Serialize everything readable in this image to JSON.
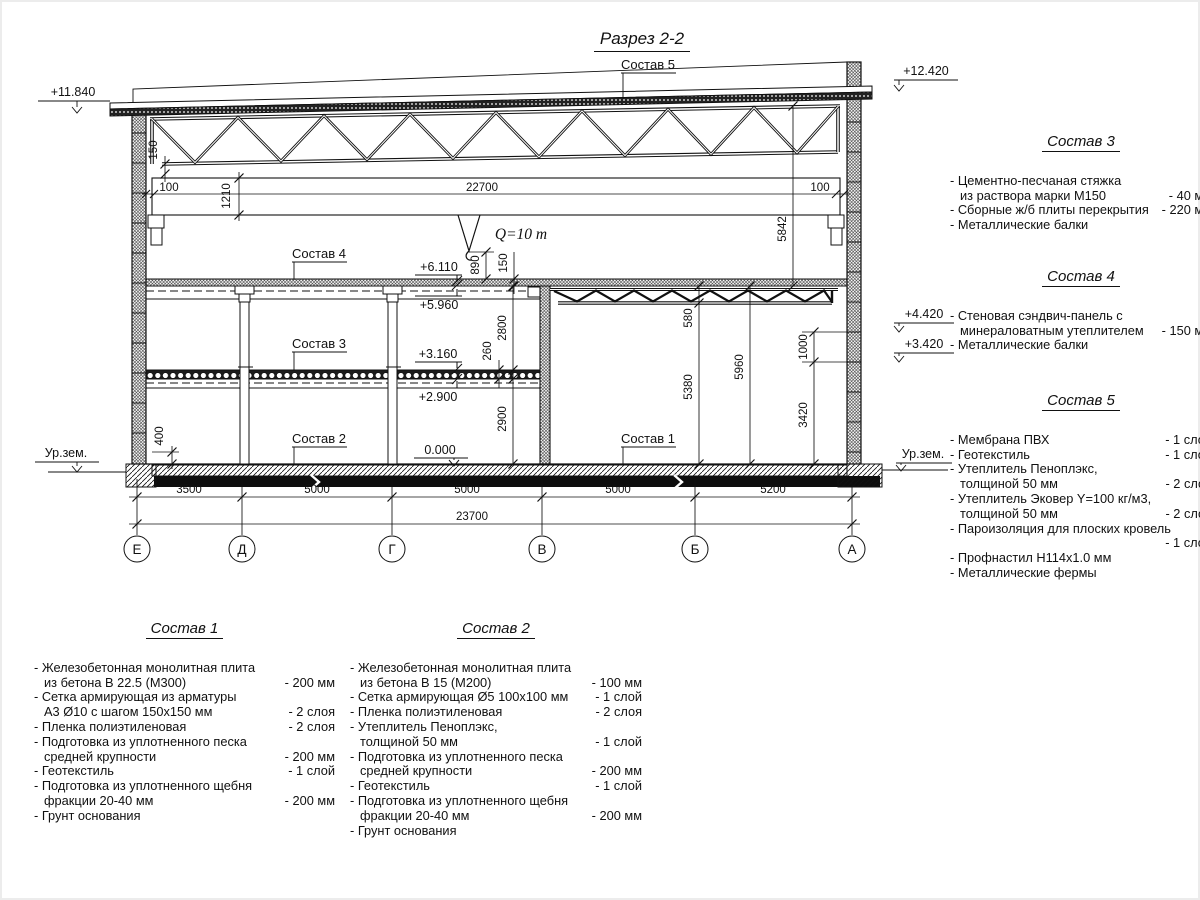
{
  "title": "Разрез 2-2",
  "drawing": {
    "crane_label": "Q=10 т",
    "leaders": {
      "sostav5": "Состав 5",
      "sostav4": "Состав 4",
      "sostav3": "Состав 3",
      "sostav2": "Состав 2",
      "sostav1": "Состав 1"
    },
    "elevations": {
      "roof_left": "+11.840",
      "roof_right": "+12.420",
      "wall_upper": "+4.420",
      "wall_lower": "+3.420",
      "floor2_top": "+6.110",
      "floor2_bottom": "+5.960",
      "floor1_top": "+3.160",
      "floor1_bottom": "+2.900",
      "zero": "0.000",
      "ground_left": "Ур.зем.",
      "ground_right": "Ур.зем."
    },
    "dims_crane": {
      "left_gap": "100",
      "length": "22700",
      "right_gap": "100"
    },
    "dims_bottom": {
      "spans": [
        "3500",
        "5000",
        "5000",
        "5000",
        "5200"
      ],
      "total": "23700"
    },
    "dims_vertical": {
      "v150_left": "150",
      "v1210": "1210",
      "v890": "890",
      "v150_mid": "150",
      "v2800": "2800",
      "v260": "260",
      "v2900": "2900",
      "v400": "400",
      "v5842": "5842",
      "v580": "580",
      "v5380": "5380",
      "v5960": "5960",
      "v1000": "1000",
      "v3420": "3420"
    },
    "axes": [
      "Е",
      "Д",
      "Г",
      "В",
      "Б",
      "А"
    ]
  },
  "compositions": {
    "comp1": {
      "title": "Состав 1",
      "items": [
        {
          "text": "- Железобетонная  монолитная плита\nиз бетона В 22.5 (М300)",
          "value": "- 200 мм"
        },
        {
          "text": "- Сетка армирующая из арматуры\nА3 Ø10 с шагом 150х150 мм",
          "value": "- 2 слоя"
        },
        {
          "text": "- Пленка полиэтиленовая",
          "value": "- 2 слоя"
        },
        {
          "text": "- Подготовка из уплотненного песка\nсредней крупности",
          "value": "- 200 мм"
        },
        {
          "text": "- Геотекстиль",
          "value": "- 1 слой"
        },
        {
          "text": "- Подготовка из уплотненного щебня\nфракции 20-40 мм",
          "value": "- 200 мм"
        },
        {
          "text": "- Грунт основания",
          "value": ""
        }
      ]
    },
    "comp2": {
      "title": "Состав 2",
      "items": [
        {
          "text": "- Железобетонная  монолитная плита\nиз бетона В 15 (М200)",
          "value": "- 100 мм"
        },
        {
          "text": "- Сетка армирующая Ø5 100х100 мм",
          "value": "- 1 слой"
        },
        {
          "text": "- Пленка полиэтиленовая",
          "value": "- 2 слоя"
        },
        {
          "text": "- Утеплитель Пеноплэкс,\nтолщиной 50 мм",
          "value": "- 1 слой"
        },
        {
          "text": "- Подготовка из уплотненного песка\nсредней крупности",
          "value": "- 200 мм"
        },
        {
          "text": "- Геотекстиль",
          "value": "- 1 слой"
        },
        {
          "text": "- Подготовка из уплотненного щебня\nфракции 20-40 мм",
          "value": "- 200 мм"
        },
        {
          "text": "- Грунт основания",
          "value": ""
        }
      ]
    },
    "comp3": {
      "title": "Состав 3",
      "items": [
        {
          "text": "- Цементно-песчаная стяжка\nиз раствора марки М150",
          "value": "- 40 мм"
        },
        {
          "text": "- Сборные ж/б плиты перекрытия",
          "value": "- 220 мм"
        },
        {
          "text": "- Металлические балки",
          "value": ""
        }
      ]
    },
    "comp4": {
      "title": "Состав 4",
      "items": [
        {
          "text": "- Стеновая сэндвич-панель с\nминераловатным утеплителем",
          "value": "- 150 мм"
        },
        {
          "text": "- Металлические балки",
          "value": ""
        }
      ]
    },
    "comp5": {
      "title": "Состав 5",
      "items": [
        {
          "text": "- Мембрана ПВХ",
          "value": "- 1 слой"
        },
        {
          "text": "- Геотекстиль",
          "value": "- 1 слой"
        },
        {
          "text": "- Утеплитель Пеноплэкс,\nтолщиной 50 мм",
          "value": "- 2 слоя"
        },
        {
          "text": "- Утеплитель Эковер Y=100 кг/м3,\nтолщиной 50 мм",
          "value": "- 2 слоя"
        },
        {
          "text": "- Пароизоляция для плоских кровель",
          "value": "- 1 слой",
          "own_line": true
        },
        {
          "text": "- Профнастил Н114х1.0 мм",
          "value": ""
        },
        {
          "text": "- Металлические фермы",
          "value": ""
        }
      ]
    }
  }
}
